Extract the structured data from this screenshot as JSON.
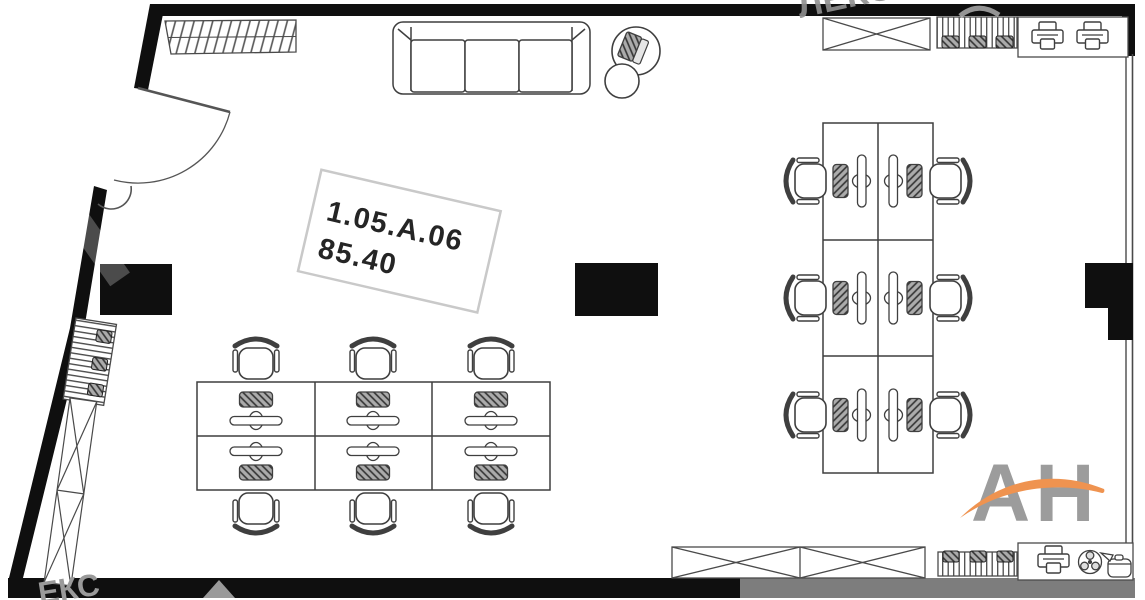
{
  "room_label": {
    "code": "1.05.A.06",
    "area": "85.40"
  },
  "watermark": {
    "logo_text": "АН",
    "brand_text_top": "ЛЕКС",
    "brand_text_bottom": "ЕКС"
  },
  "colors": {
    "wall_black": "#0f0f0f",
    "line_dark": "#3f3f3f",
    "wall_gray_overlay": "#7d7d7d",
    "logo_gray": "#9c9c9c",
    "logo_orange": "#ef9350"
  }
}
